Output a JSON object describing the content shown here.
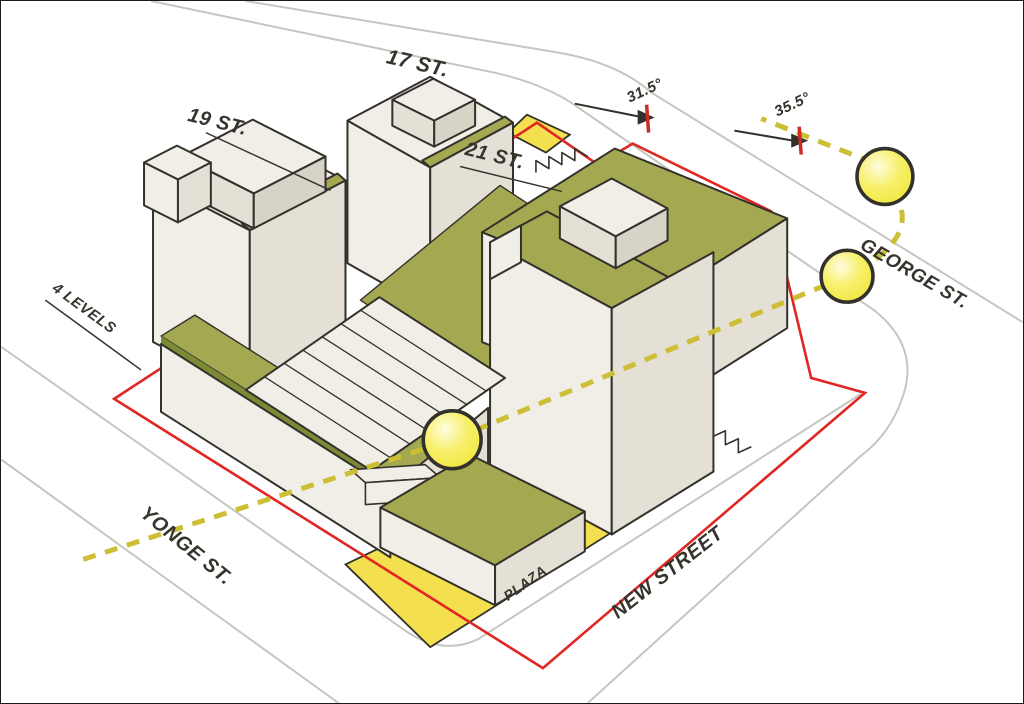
{
  "diagram": {
    "title": "Development massing and sun angle study",
    "labels": {
      "street_17": "17 ST.",
      "tower_19": "19 ST.",
      "tower_21": "21 ST.",
      "george_st": "GEORGE ST.",
      "new_street": "NEW STREET",
      "yonge_st": "YONGE ST.",
      "plaza": "PLAZA",
      "levels": "4 LEVELS",
      "angle_north": "31.5°",
      "angle_east": "35.5°"
    },
    "colors": {
      "background": "#ffffff",
      "outline": "#32312b",
      "street_line": "#c6c6c0",
      "property_line": "#e02723",
      "face_light": "#f1eee7",
      "face_mid": "#e4e0d6",
      "face_dark": "#d8d3c7",
      "green_roof": "#a4a851",
      "green_side": "#8e9940",
      "green_edge": "#7c8a35",
      "plaza_yellow": "#f4df4e",
      "sun_dash": "#cdbf35",
      "sun_core": "#f0e434",
      "sun_mid": "#f7f06a",
      "sun_glow": "#fffce0",
      "label": "#35342d",
      "tick_red": "#cc2a24"
    }
  }
}
